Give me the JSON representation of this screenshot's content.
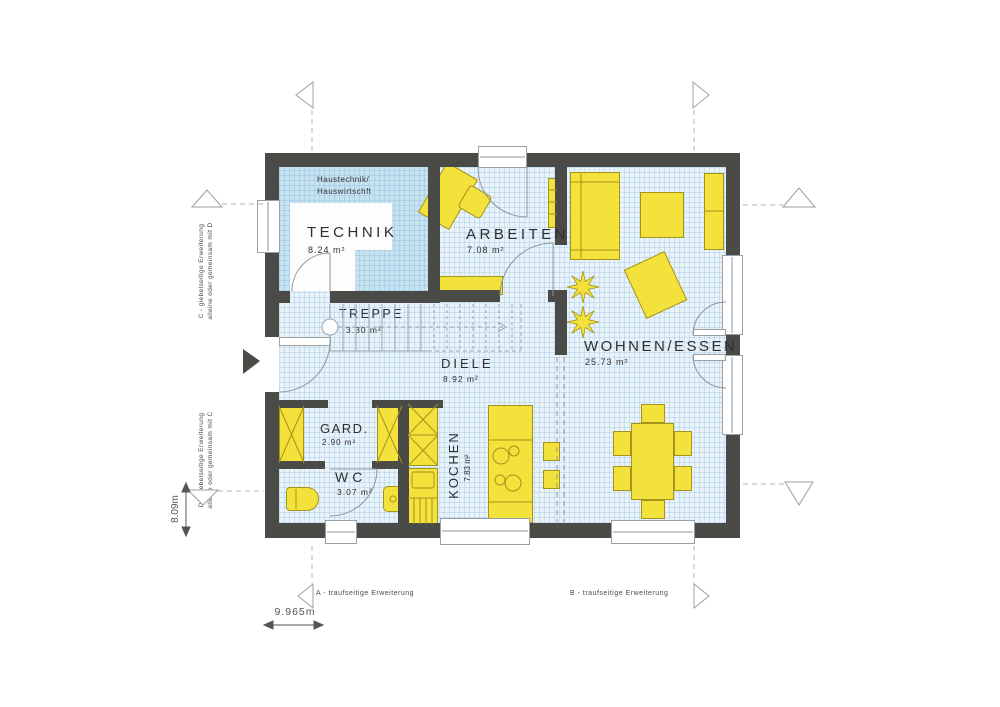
{
  "title": "Grundriss Erdgeschoss",
  "colors": {
    "wall": "#4a4a47",
    "floor": "#eaf3fa",
    "technik": "#c6e3f2",
    "furn": "#f3e13c",
    "furnb": "#a5941a",
    "line": "#8f959a",
    "text": "#2f2f2f"
  },
  "rooms": {
    "technik": {
      "note_line1": "Haustechnik/",
      "note_line2": "Hauswirtschft",
      "name": "TECHNIK",
      "area": "8.24 m²"
    },
    "arbeiten": {
      "name": "ARBEITEN",
      "area": "7.08 m²"
    },
    "treppe": {
      "name": "TREPPE",
      "area": "3.30 m²"
    },
    "diele": {
      "name": "DIELE",
      "area": "8.92 m²"
    },
    "wohnen_essen": {
      "name": "WOHNEN/ESSEN",
      "area": "25.73 m²"
    },
    "garderobe": {
      "name": "GARD.",
      "area": "2.90 m²"
    },
    "wc": {
      "name": "WC",
      "area": "3.07 m²"
    },
    "kochen": {
      "name": "KOCHEN",
      "area": "7.83 m²"
    }
  },
  "annotations": {
    "extension_c_line1": "C - giebelseitige Erweiterung",
    "extension_c_line2": "alleine oder gemeinsam mit D",
    "extension_d_line1": "D - giebelseitige Erweiterung",
    "extension_d_line2": "alleine oder gemeinsam mit C",
    "extension_a": "A - traufseitige Erweiterung",
    "extension_b": "B - traufseitige Erweiterung"
  },
  "dimensions": {
    "height": "8.09m",
    "width": "9.965m"
  }
}
